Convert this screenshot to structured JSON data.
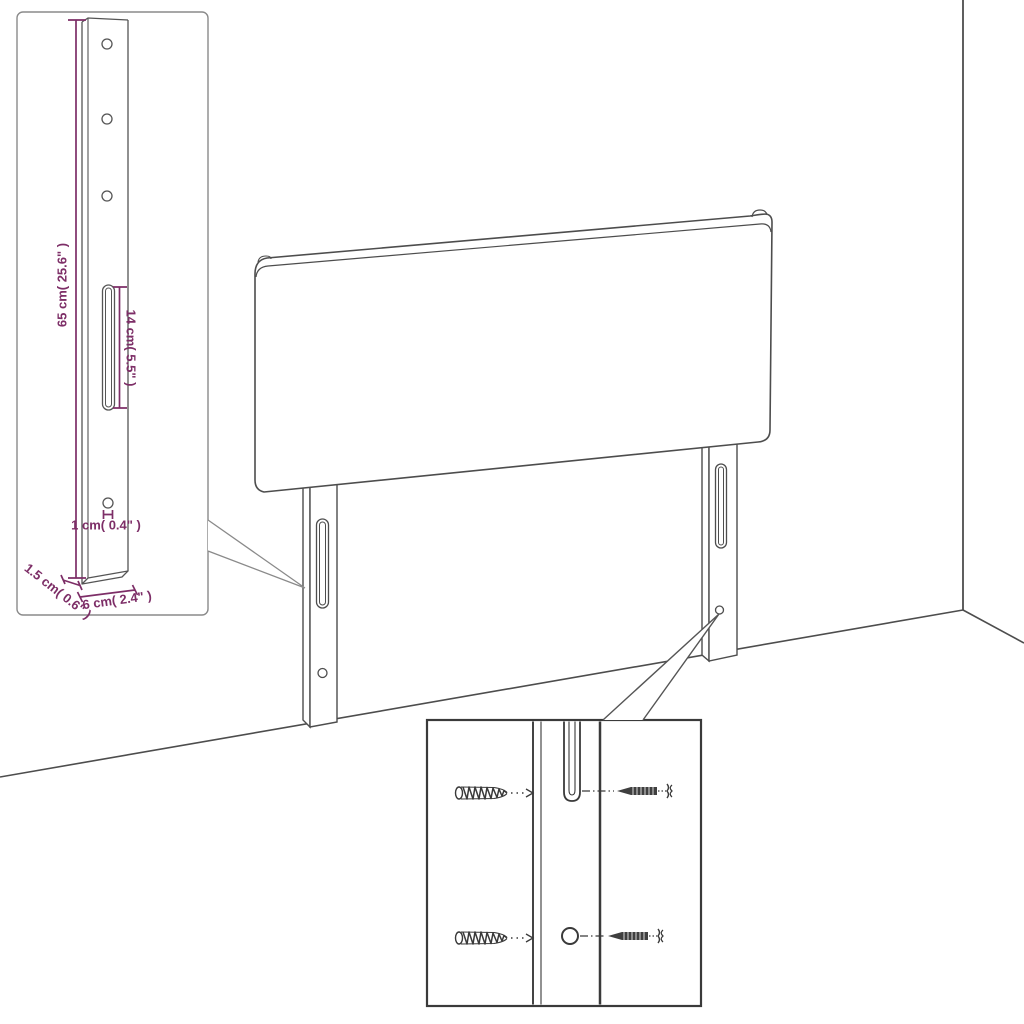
{
  "page": {
    "background": "#ffffff",
    "title": "headboard-dimension-diagram"
  },
  "colors": {
    "dimension": "#7D2E67",
    "outline": "#4D4D4D",
    "detail_outline": "#3A3A3A",
    "inset_border": "#8A8A8A"
  },
  "dimension_labels": {
    "height": "65 cm( 25.6\" )",
    "slot": "14 cm( 5.5\" )",
    "hole": "1 cm( 0.4\" )",
    "depth": "1.5 cm( 0.6\" )",
    "width": "6 cm( 2.4\" )"
  },
  "icons": {
    "left_inset": "leg-dimension-detail",
    "bottom_inset": "screw-mounting-detail",
    "threaded_screw": "threaded-screw-icon",
    "pointed_screw": "pointed-screw-icon"
  }
}
